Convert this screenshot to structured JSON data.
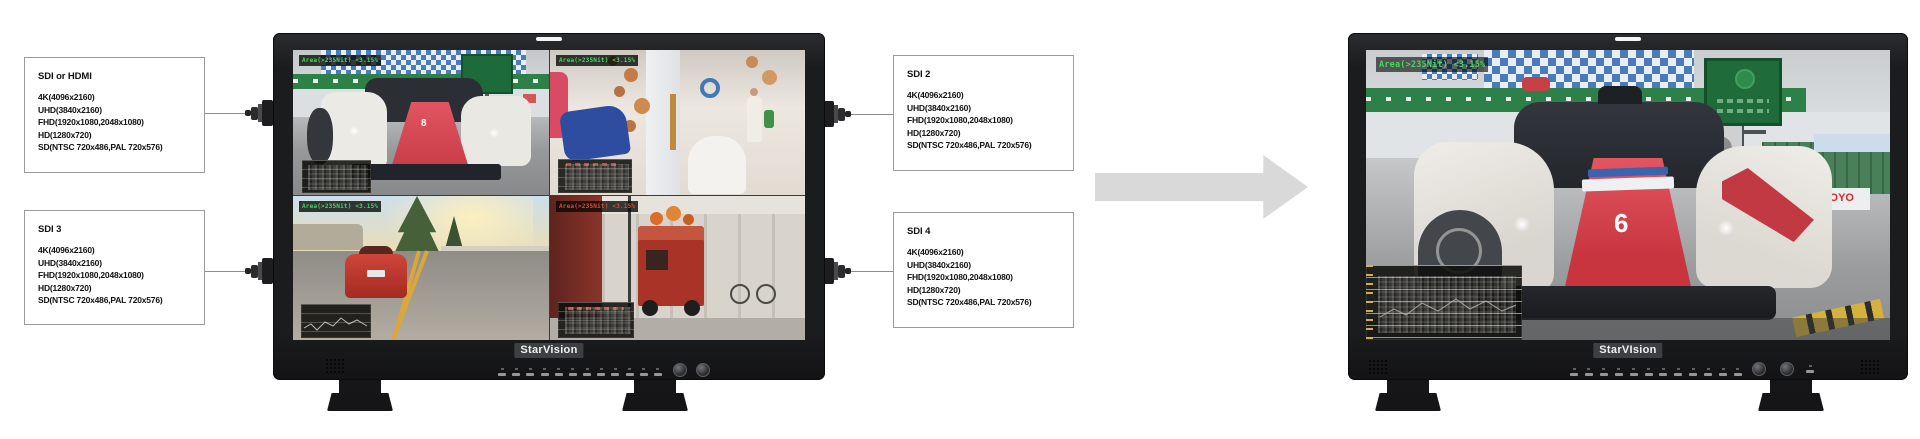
{
  "spec_boxes": [
    {
      "position": "top-left",
      "title": "SDI or HDMI",
      "lines": [
        "4K(4096x2160)",
        "UHD(3840x2160)",
        "FHD(1920x1080,2048x1080)",
        "HD(1280x720)",
        "SD(NTSC 720x486,PAL 720x576)"
      ]
    },
    {
      "position": "bottom-left",
      "title": "SDI 3",
      "lines": [
        "4K(4096x2160)",
        "UHD(3840x2160)",
        "FHD(1920x1080,2048x1080)",
        "HD(1280x720)",
        "SD(NTSC 720x486,PAL 720x576)"
      ]
    },
    {
      "position": "top-right",
      "title": "SDI 2",
      "lines": [
        "4K(4096x2160)",
        "UHD(3840x2160)",
        "FHD(1920x1080,2048x1080)",
        "HD(1280x720)",
        "SD(NTSC 720x486,PAL 720x576)"
      ]
    },
    {
      "position": "bottom-right",
      "title": "SDI 4",
      "lines": [
        "4K(4096x2160)",
        "UHD(3840x2160)",
        "FHD(1920x1080,2048x1080)",
        "HD(1280x720)",
        "SD(NTSC 720x486,PAL 720x576)"
      ]
    }
  ],
  "monitors": {
    "left": {
      "brand": "StarVision",
      "view": "quad-split",
      "quadrants": [
        {
          "label": "race-car-feed",
          "overlay_text": "Area(>235Nit) <3.15%",
          "overlay_color": "#45d95c",
          "car_number": "8"
        },
        {
          "label": "boutique-interior-feed",
          "overlay_text": "Area(>235Nit) <3.15%",
          "overlay_color": "#45d95c"
        },
        {
          "label": "road-sports-car-feed",
          "overlay_text": "Area(>235Nit) <3.15%",
          "overlay_color": "#45d95c"
        },
        {
          "label": "street-cart-feed",
          "overlay_text": "Area(>235Nit) <3.15%",
          "overlay_color": "#e4493a"
        }
      ]
    },
    "right": {
      "brand": "StarVIsion",
      "view": "full-screen",
      "overlay_text": "Area(>235Nit) <3.15%",
      "billboard_text": "SLIGHTLY MAD",
      "sponsor_text": "TOYO",
      "car_number": "6"
    }
  },
  "colors": {
    "overlay_green": "#45d95c",
    "overlay_red": "#e4493a",
    "arrow": "#d9d9d9",
    "box_border": "#9b9b9b",
    "bezel": "#1b1c1e",
    "race_car_red": "#d8454e",
    "banner_green": "#2e8049",
    "checker_blue": "#4b7cba"
  }
}
